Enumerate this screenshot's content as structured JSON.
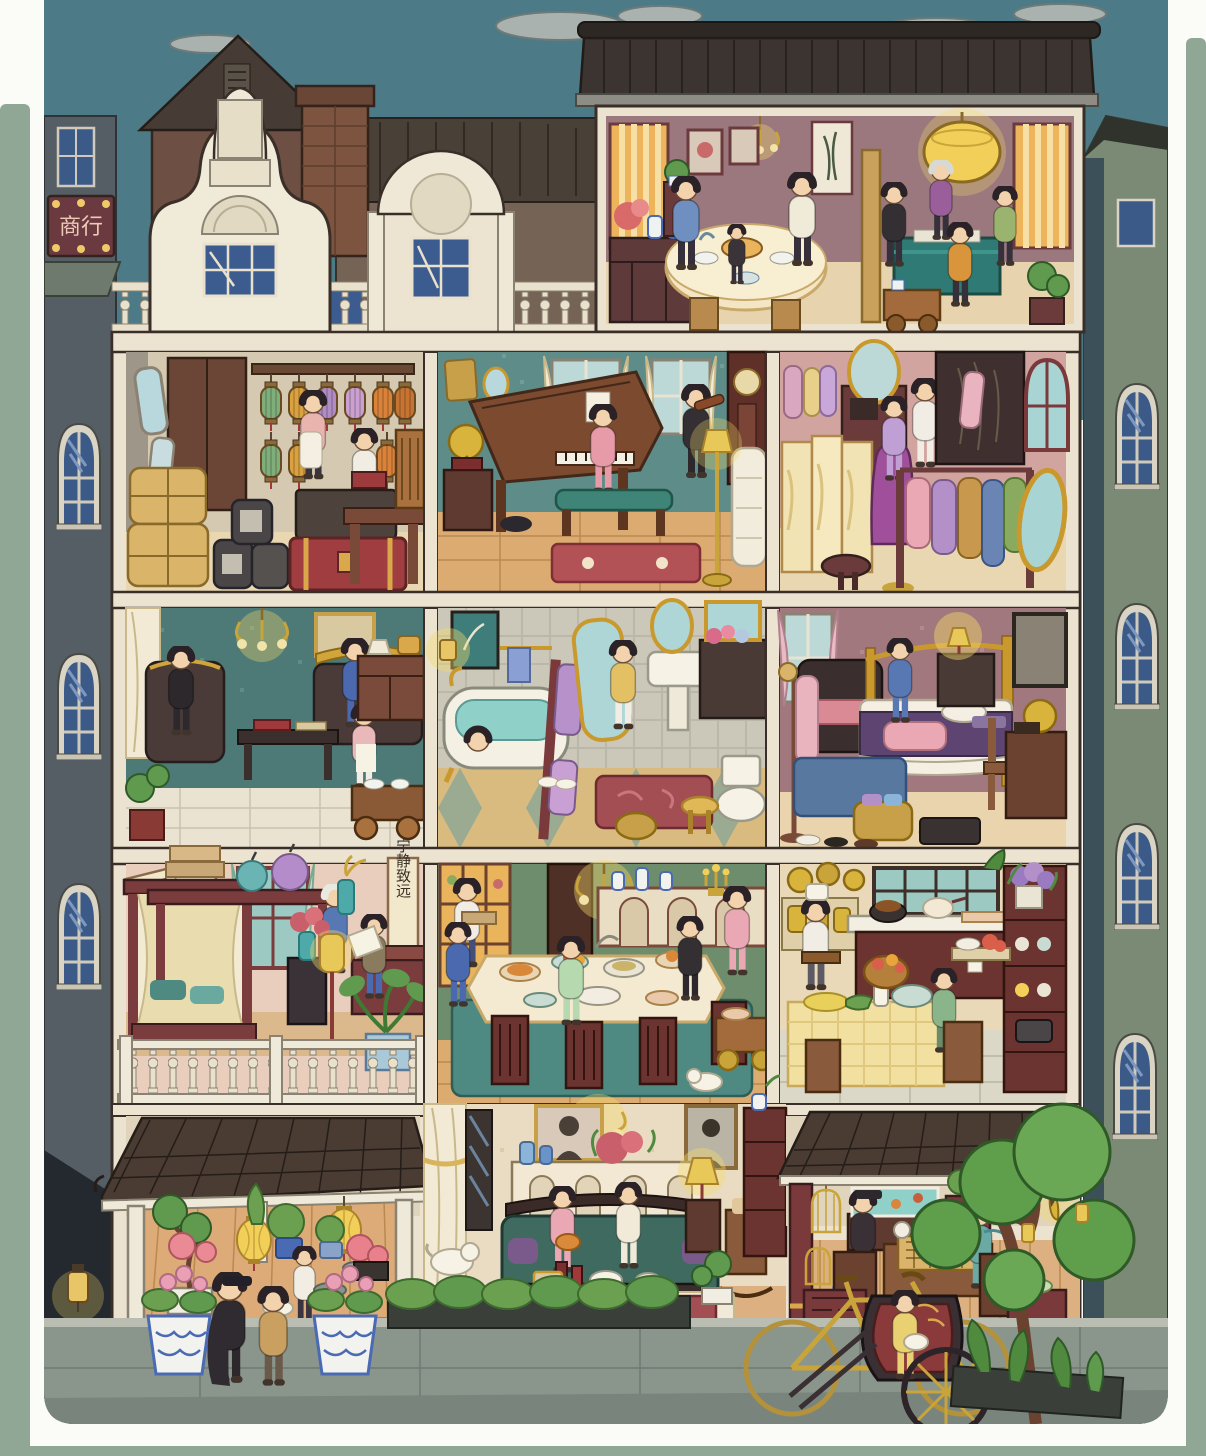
{
  "artwork": {
    "kind": "hidden-object game scene",
    "description": "Cross-section dollhouse view of a 1920s Shanghai mansion at dusk, five levels of rooms with family daily-life scenes, framed by a rounded white card on a sage-green border"
  },
  "signs": {
    "shop_sign": "商行",
    "calligraphy_scroll": "宁静致远"
  },
  "palette": {
    "border_sage": "#91a795",
    "card_white": "#fbfbf7",
    "sky": "#4d7a87",
    "cloud": "#a9b2ae",
    "facade_cream": "#ebe3d0",
    "gable_white": "#f0ead9",
    "tile_roof": "#3b3430",
    "left_building_gray": "#565e65",
    "right_building_green": "#7b8a74",
    "sidewalk": "#8a958c",
    "lantern_yellow": "#f2cf59",
    "trunk_red": "#a03d41",
    "mahjong_teal": "#2f7a74",
    "sofa_green": "#3f6a5f",
    "rug_red": "#a24e52",
    "wall_mauve": "#9a787e",
    "wall_teal": "#4d7976",
    "wall_pink": "#d2a4a0",
    "wall_green": "#6e8d6c",
    "wood_floor": "#dcab72"
  },
  "floors": [
    {
      "name": "top floor",
      "rooms": [
        {
          "name": "rooftop facade",
          "objects": [
            "dutch gable large",
            "dutch gable small",
            "balustrade",
            "blue windows"
          ],
          "figures": 0
        },
        {
          "name": "tea and mahjong room",
          "objects": [
            "round tea table",
            "wicker chairs",
            "sideboard with porcelain",
            "folding screen",
            "mahjong table",
            "drum lantern",
            "tea cart",
            "bonsai",
            "chandelier"
          ],
          "figures": 8
        }
      ]
    },
    {
      "name": "second floor",
      "rooms": [
        {
          "name": "storage room",
          "objects": [
            "hanging lanterns",
            "wardrobe",
            "mirrors",
            "wicker bales",
            "jars",
            "suitcase",
            "red trunk",
            "desk",
            "chair"
          ],
          "figures": 2
        },
        {
          "name": "music room",
          "objects": [
            "grand piano",
            "piano bench",
            "violin",
            "gramophone",
            "grandfather clock",
            "white sofa",
            "floor lamp",
            "red rug",
            "curtained windows"
          ],
          "figures": 2
        },
        {
          "name": "dressing room",
          "objects": [
            "vanity with oval mirror",
            "folding screen",
            "stool",
            "mannequin",
            "wardrobe",
            "clothes rack with qipao",
            "cheval mirror",
            "arched window"
          ],
          "figures": 2
        }
      ]
    },
    {
      "name": "third floor",
      "rooms": [
        {
          "name": "study parlor",
          "objects": [
            "chandelier",
            "dark sofa with gold crest",
            "armchair",
            "coffee table with books",
            "tea trolley",
            "sideboard with lamp",
            "painting",
            "bonsai"
          ],
          "figures": 3
        },
        {
          "name": "bathroom",
          "objects": [
            "clawfoot tub",
            "cheval mirror",
            "pedestal sink",
            "oval mirror",
            "vanity cabinet",
            "toilet",
            "red rug",
            "wicker stool",
            "basket",
            "towels",
            "sconce"
          ],
          "figures": 2
        },
        {
          "name": "bedroom",
          "objects": [
            "gold frame bed",
            "purple bedspread",
            "nightstand with lamp",
            "chaise with pink cushion",
            "coat stand",
            "blue rug",
            "laundry basket",
            "slippers",
            "suitcase",
            "desk with gramophone"
          ],
          "figures": 1
        }
      ]
    },
    {
      "name": "fourth floor",
      "rooms": [
        {
          "name": "grandmother room",
          "objects": [
            "canopy bed",
            "console with boxes and bundles",
            "calligraphy scroll",
            "plaque",
            "floor lamp",
            "rose vase stand",
            "potted plant",
            "desk",
            "balcony railing"
          ],
          "figures": 2
        },
        {
          "name": "banquet dining room",
          "objects": [
            "long table with feast",
            "maroon chairs",
            "sideboard with vases",
            "chandelier",
            "candelabra",
            "stained glass door",
            "serving cart",
            "teal rug",
            "white cat"
          ],
          "figures": 5
        },
        {
          "name": "kitchen",
          "objects": [
            "stove island with pots",
            "hanging pans",
            "kettle shelf",
            "hutch with dishes",
            "hydrangea pot",
            "yellow checked table",
            "food baskets"
          ],
          "figures": 2
        }
      ]
    },
    {
      "name": "ground floor",
      "rooms": [
        {
          "name": "garden porch",
          "objects": [
            "tiled eave",
            "white columns",
            "paper lanterns",
            "bonsai with blossoms",
            "potted plants",
            "stepping stones",
            "white cat",
            "steps"
          ],
          "figures": 1
        },
        {
          "name": "parlor",
          "objects": [
            "chandelier",
            "portraits",
            "mantel console with vases and flowers",
            "green sofa",
            "coffee table with wine and teapot",
            "table lamp",
            "rocking chair",
            "bookcase",
            "white dog",
            "red rug",
            "gold curtain"
          ],
          "figures": 2
        },
        {
          "name": "go game veranda",
          "objects": [
            "go board table",
            "birdcages",
            "goldfish tank",
            "flower stand",
            "maroon column",
            "falling leaves",
            "side tables"
          ],
          "figures": 2
        }
      ]
    },
    {
      "name": "street",
      "rooms": [
        {
          "name": "sidewalk",
          "objects": [
            "blue-white planters with pink flowers",
            "strolling couple",
            "hedge trough",
            "golden bicycle",
            "rickshaw with passenger holding cat",
            "pine tree",
            "wall lantern",
            "corner plants"
          ],
          "figures": 3
        }
      ]
    }
  ]
}
